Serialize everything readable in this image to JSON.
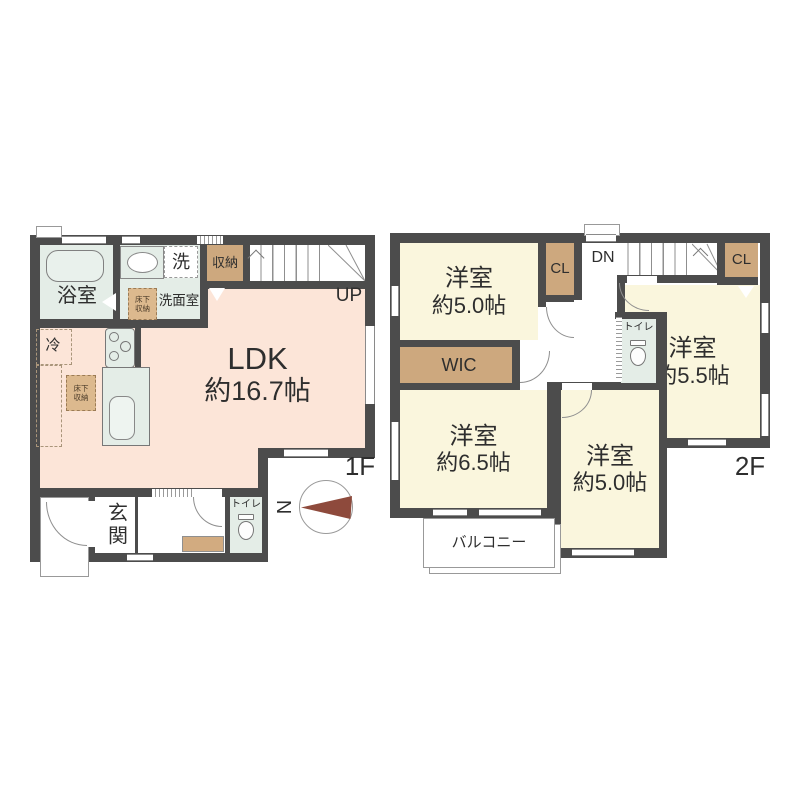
{
  "colors": {
    "wall": "#4c4c4c",
    "ldk_fill": "#fce5d8",
    "bedroom_fill": "#faf6dd",
    "wet_area_fill": "#e4ede7",
    "closet_fill": "#cda87e",
    "underfloor_fill": "#dcb98e",
    "compass_needle": "#8e4a3c",
    "text": "#2e2e2e"
  },
  "floor1": {
    "floor_label": "1F",
    "bathroom": "浴室",
    "washroom": "洗面室",
    "washer": "洗",
    "storage": "収納",
    "underfloor_storage_a": "床下収納",
    "underfloor_storage_b": "床下収納",
    "fridge": "冷",
    "ldk_name": "LDK",
    "ldk_size": "約16.7帖",
    "stairs": "UP",
    "entrance": "玄関",
    "toilet": "トイレ",
    "compass_north": "N"
  },
  "floor2": {
    "floor_label": "2F",
    "bedroom_nw_name": "洋室",
    "bedroom_nw_size": "約5.0帖",
    "closet_a": "CL",
    "stairs": "DN",
    "closet_b": "CL",
    "bedroom_e_name": "洋室",
    "bedroom_e_size": "約5.5帖",
    "wic": "WIC",
    "toilet": "トイレ",
    "bedroom_sw_name": "洋室",
    "bedroom_sw_size": "約6.5帖",
    "bedroom_s_name": "洋室",
    "bedroom_s_size": "約5.0帖",
    "balcony": "バルコニー"
  }
}
